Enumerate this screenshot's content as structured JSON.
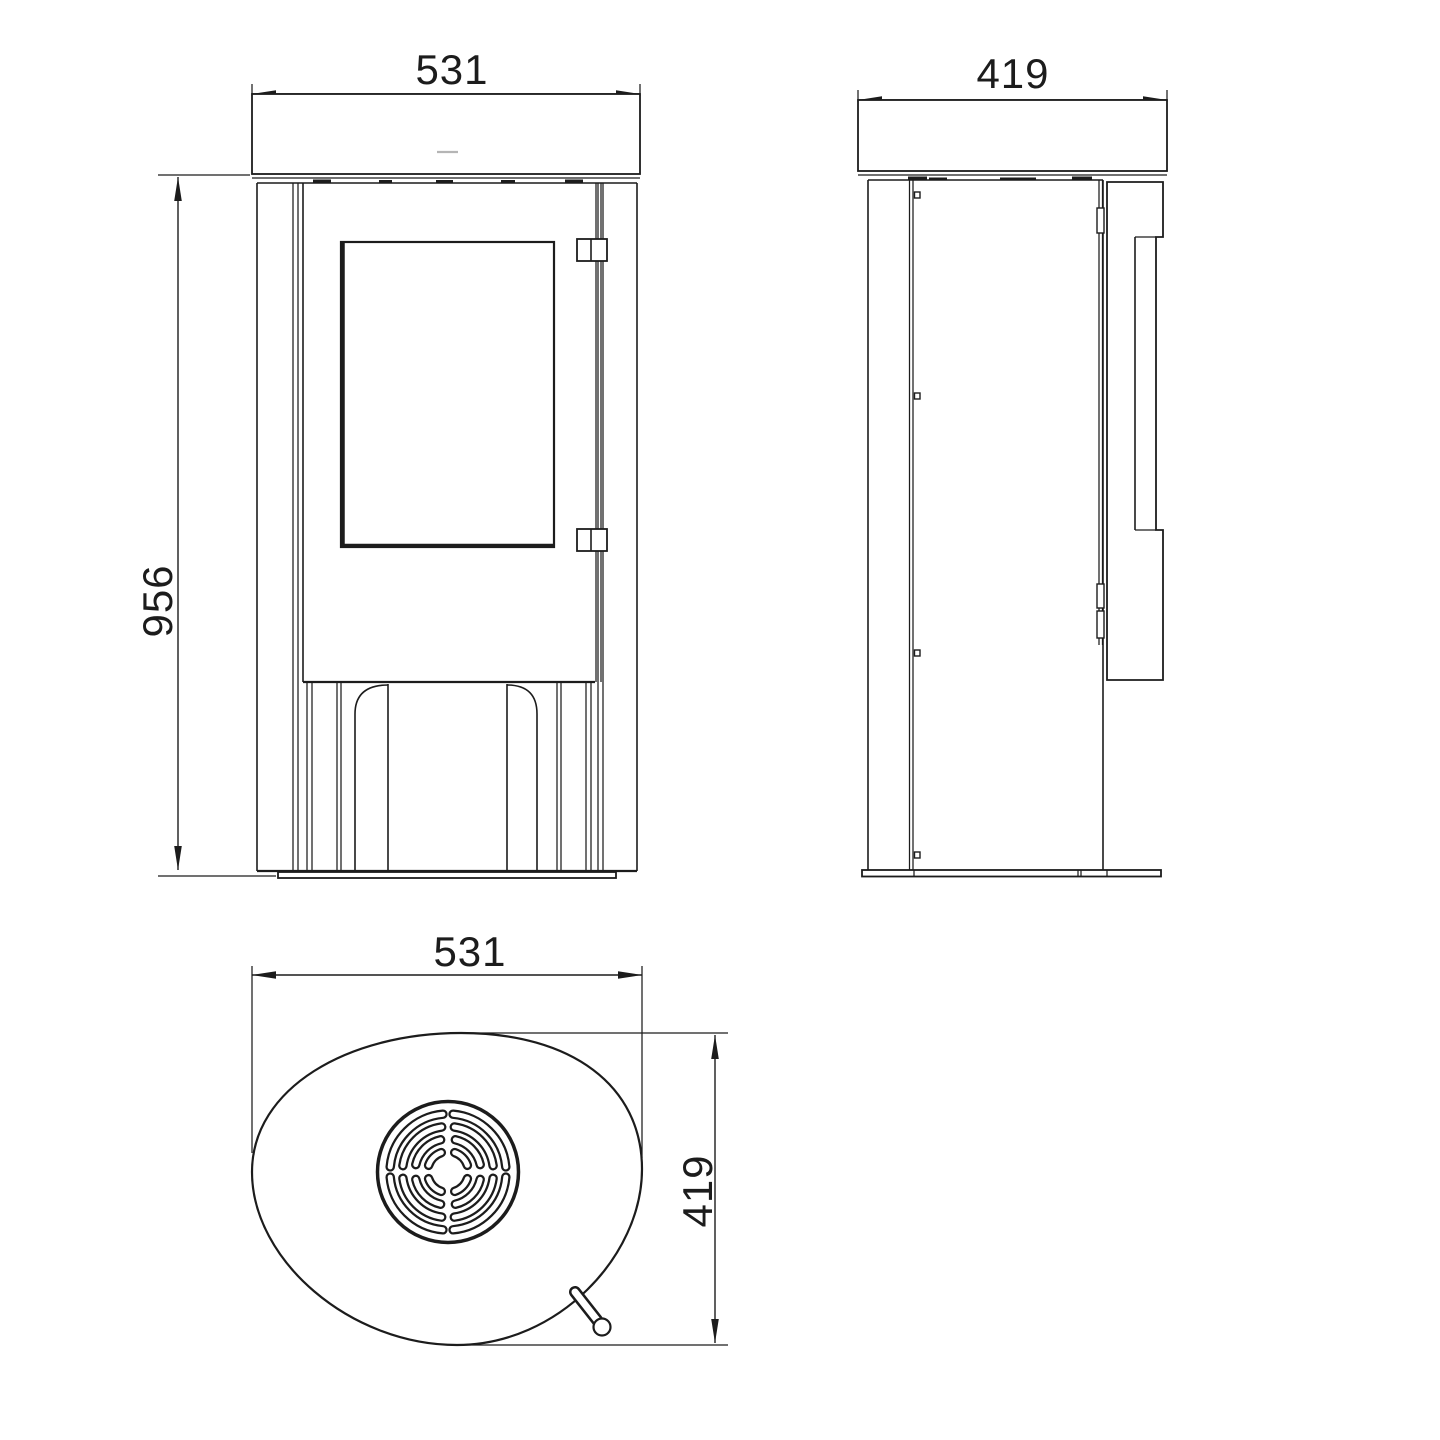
{
  "document": {
    "type": "technical dimension drawing",
    "subject": "oval wood-burning stove shown in three orthographic views (front, side, top)"
  },
  "views": {
    "front": {
      "name": "front view",
      "width_mm": "531",
      "height_mm": "956"
    },
    "side": {
      "name": "side view",
      "depth_mm": "419"
    },
    "top": {
      "name": "top view",
      "width_mm": "531",
      "depth_mm": "419"
    }
  },
  "colors": {
    "line": "#1c1c1c",
    "background": "#ffffff",
    "plate_mark": "#b5b5b5"
  }
}
